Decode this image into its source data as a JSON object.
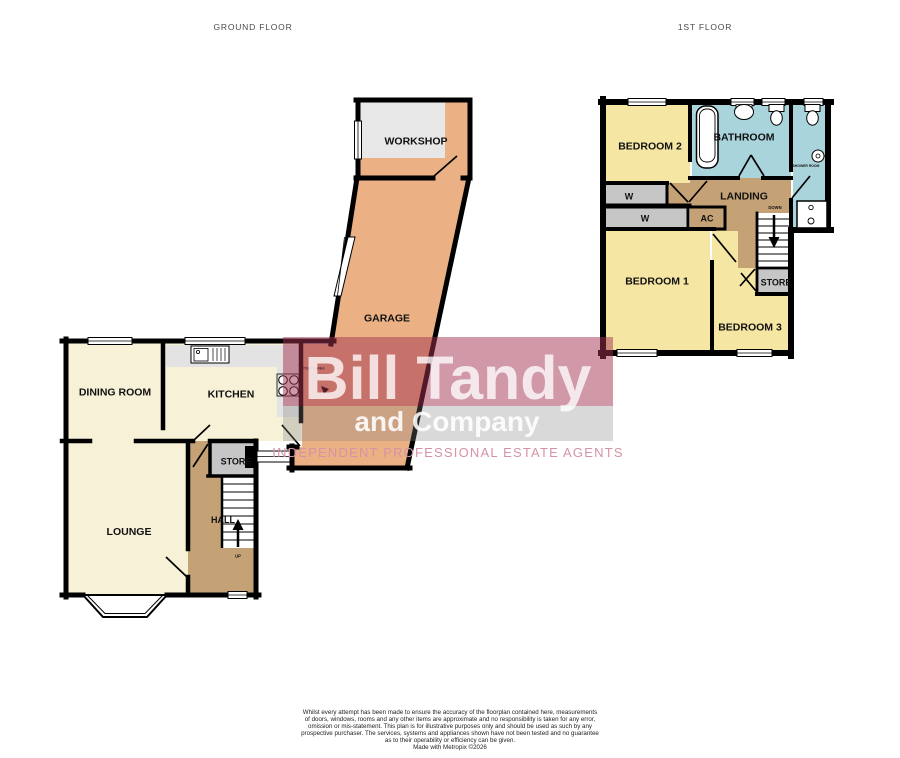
{
  "header": {
    "ground_floor_label": "GROUND FLOOR",
    "first_floor_label": "1ST FLOOR"
  },
  "ground_floor": {
    "workshop": "WORKSHOP",
    "garage": "GARAGE",
    "utility_area": "UTILITY AREA",
    "dining_room": "DINING ROOM",
    "kitchen": "KITCHEN",
    "store": "STORE",
    "hall": "HALL",
    "up": "UP",
    "lounge": "LOUNGE"
  },
  "first_floor": {
    "bedroom_2": "BEDROOM 2",
    "bathroom": "BATHROOM",
    "shower_room": "SHOWER ROOM",
    "wardrobe_1": "W",
    "wardrobe_2": "W",
    "airing_cupboard": "AC",
    "landing": "LANDING",
    "down": "DOWN",
    "bedroom_1": "BEDROOM 1",
    "store": "STORE",
    "bedroom_3": "BEDROOM 3"
  },
  "watermark": {
    "name": "Bill Tandy",
    "company": "and Company",
    "tagline": "INDEPENDENT PROFESSIONAL ESTATE AGENTS"
  },
  "disclaimer": {
    "lines": [
      "Whilst every attempt has been made to ensure the accuracy of the floorplan contained here, measurements",
      "of doors, windows, rooms and any other items are approximate and no responsibility is taken for any error,",
      "omission or mis-statement. This plan is for illustrative purposes only and should be used as such by any",
      "prospective purchaser. The services, systems and appliances shown have not been tested and no guarantee",
      "as to their operability or efficiency can be given.",
      "Made with Metropix ©2026"
    ]
  },
  "colors": {
    "cream": "#F7F1D8",
    "yellow": "#F5E6A4",
    "blue": "#AAD4DC",
    "orange": "#EBB185",
    "tan": "#C4A276",
    "closet_gray": "#C6C6C6",
    "counter_gray": "#E3E3E3",
    "workshop_gray": "#E7E7E7",
    "wall": "#000000",
    "label": "#111111",
    "header_text": "#4A4A4A",
    "wm_band_pink": "rgba(164,49,82,0.50)",
    "wm_band_gray": "rgba(130,130,130,0.30)",
    "wm_text": "rgba(255,255,255,0.78)",
    "wm_text2": "rgba(255,255,255,0.88)",
    "tagline_pink": "#D593A5",
    "disclaimer_text": "#222222"
  }
}
